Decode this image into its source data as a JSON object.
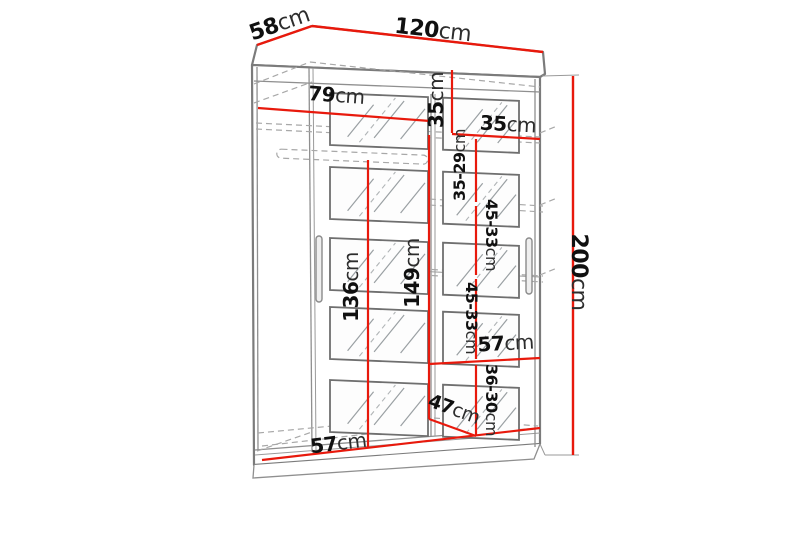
{
  "colors": {
    "dimension_line": "#e8190c",
    "structure_line": "#7b7b7b",
    "label_text": "#101010"
  },
  "dimensions": {
    "depth": {
      "value": "58",
      "unit": "cm"
    },
    "width": {
      "value": "120",
      "unit": "cm"
    },
    "height": {
      "value": "200",
      "unit": "cm"
    },
    "left_compartment_width": {
      "value": "79",
      "unit": "cm"
    },
    "top_compartment_height": {
      "value": "35",
      "unit": "cm"
    },
    "top_right_width": {
      "value": "35",
      "unit": "cm"
    },
    "shelf_spacing_top": {
      "value": "35-29",
      "unit": "cm"
    },
    "shelf_spacing_upper": {
      "value": "45-33",
      "unit": "cm"
    },
    "shelf_spacing_lower": {
      "value": "45-33",
      "unit": "cm"
    },
    "hanging_space_height": {
      "value": "136",
      "unit": "cm"
    },
    "interior_height": {
      "value": "149",
      "unit": "cm"
    },
    "bottom_right_width": {
      "value": "57",
      "unit": "cm"
    },
    "bottom_shelf_spacing": {
      "value": "36-30",
      "unit": "cm"
    },
    "bottom_depth": {
      "value": "47",
      "unit": "cm"
    },
    "bottom_left_width": {
      "value": "57",
      "unit": "cm"
    }
  }
}
